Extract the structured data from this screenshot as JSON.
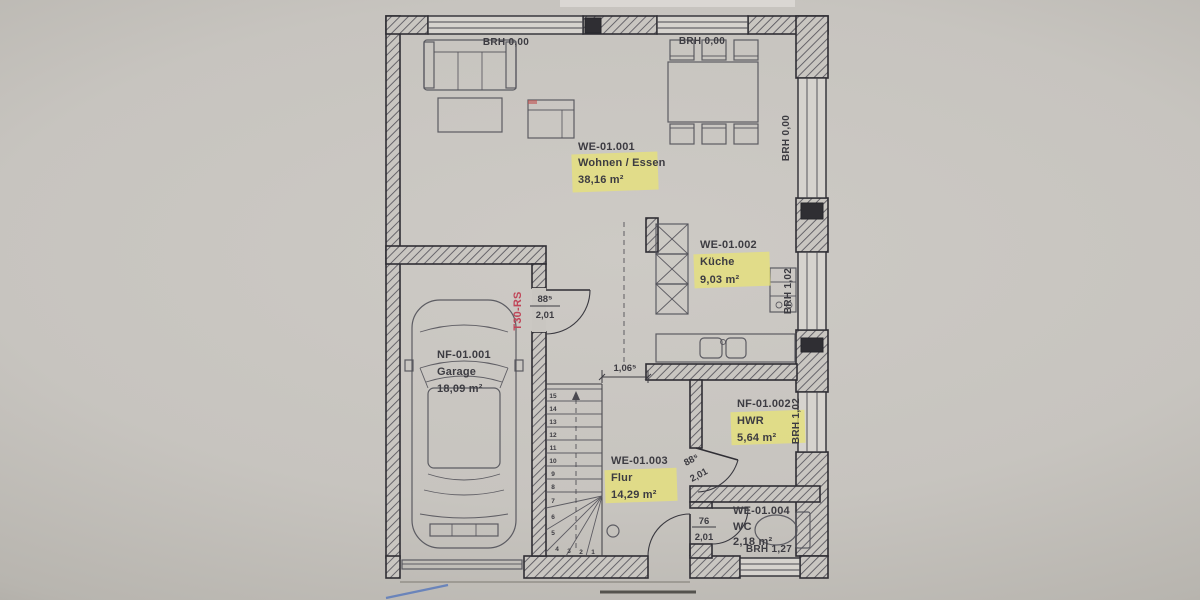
{
  "plan": {
    "sills": {
      "top_left": "BRH  0,00",
      "top_right": "BRH  0,00",
      "right_upper": "BRH  0,00",
      "kitchen": "BRH 1,02",
      "hwr": "BRH 1,02",
      "wc": "BRH 1,27"
    },
    "rooms": {
      "living": {
        "id": "WE-01.001",
        "name": "Wohnen / Essen",
        "area": "38,16 m²"
      },
      "kitchen": {
        "id": "WE-01.002",
        "name": "Küche",
        "area": "9,03 m²"
      },
      "garage": {
        "id": "NF-01.001",
        "name": "Garage",
        "area": "18,09 m²"
      },
      "hwr": {
        "id": "NF-01.002",
        "name": "HWR",
        "area": "5,64 m²"
      },
      "hall": {
        "id": "WE-01.003",
        "name": "Flur",
        "area": "14,29 m²"
      },
      "wc": {
        "id": "WE-01.004",
        "name": "WC",
        "area": "2,18 m²"
      }
    },
    "doors": {
      "garage_hall": {
        "width": "88⁵",
        "height": "2,01",
        "fire_rating": "T30-RS"
      },
      "hwr": {
        "width": "88⁵",
        "height": "2,01"
      },
      "wc": {
        "width": "76",
        "height": "2,01"
      }
    },
    "dimensions": {
      "hall_passage": "1,06⁵"
    },
    "stairs": {
      "step_numbers": [
        "15",
        "14",
        "13",
        "12",
        "11",
        "10",
        "9",
        "8",
        "7",
        "6",
        "5",
        "4",
        "3",
        "2",
        "1"
      ]
    },
    "colors": {
      "highlight": "#e7e178",
      "fire_door_text": "#c04558",
      "pen_mark": "#5577bb",
      "paper": "#c6c3be",
      "line": "#36353b"
    }
  }
}
